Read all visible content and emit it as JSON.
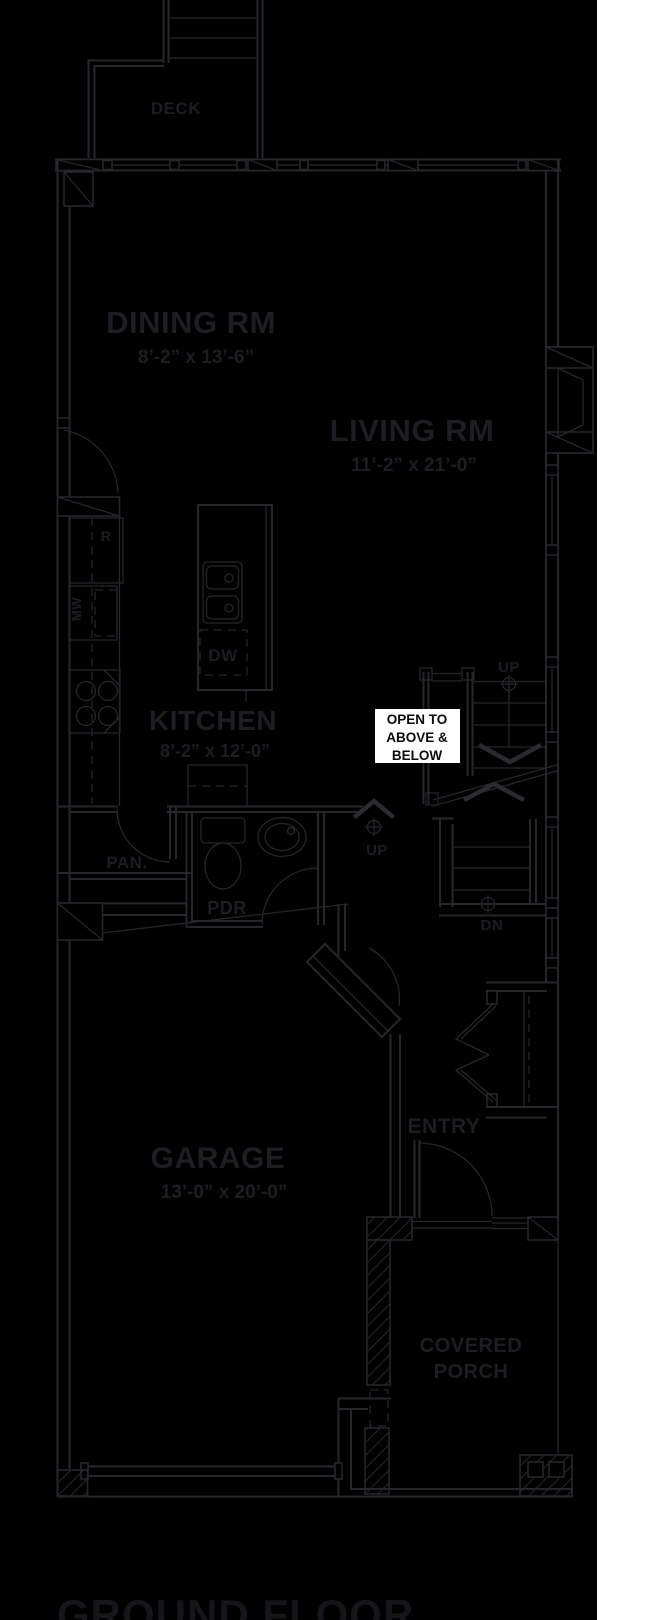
{
  "colors": {
    "page_bg": "#ffffff",
    "plan_bg": "#000000",
    "line": "#26262b",
    "label": "#1d1d22",
    "title": "#15151a",
    "note_bg": "#ffffff",
    "note_text": "#0b0b0d"
  },
  "plan": {
    "title": "GROUND FLOOR",
    "rooms": {
      "deck": {
        "name": "DECK"
      },
      "dining": {
        "name": "DINING RM",
        "dims": "8’-2” x 13’-6”"
      },
      "living": {
        "name": "LIVING RM",
        "dims": "11’-2” x 21’-0”"
      },
      "kitchen": {
        "name": "KITCHEN",
        "dims": "8’-2” x 12’-0”"
      },
      "garage": {
        "name": "GARAGE",
        "dims": "13’-0” x 20’-0”"
      },
      "pantry": {
        "name": "PAN."
      },
      "powder": {
        "name": "PDR"
      },
      "entry": {
        "name": "ENTRY"
      },
      "porch": {
        "name_line1": "COVERED",
        "name_line2": "PORCH"
      }
    },
    "appliances": {
      "fridge": "R",
      "microwave": "MW",
      "dishwasher": "DW"
    },
    "stairs": {
      "up_main": "UP",
      "up_hall": "UP",
      "down": "DN"
    },
    "note": {
      "line1": "OPEN TO",
      "line2": "ABOVE &",
      "line3": "BELOW"
    }
  }
}
